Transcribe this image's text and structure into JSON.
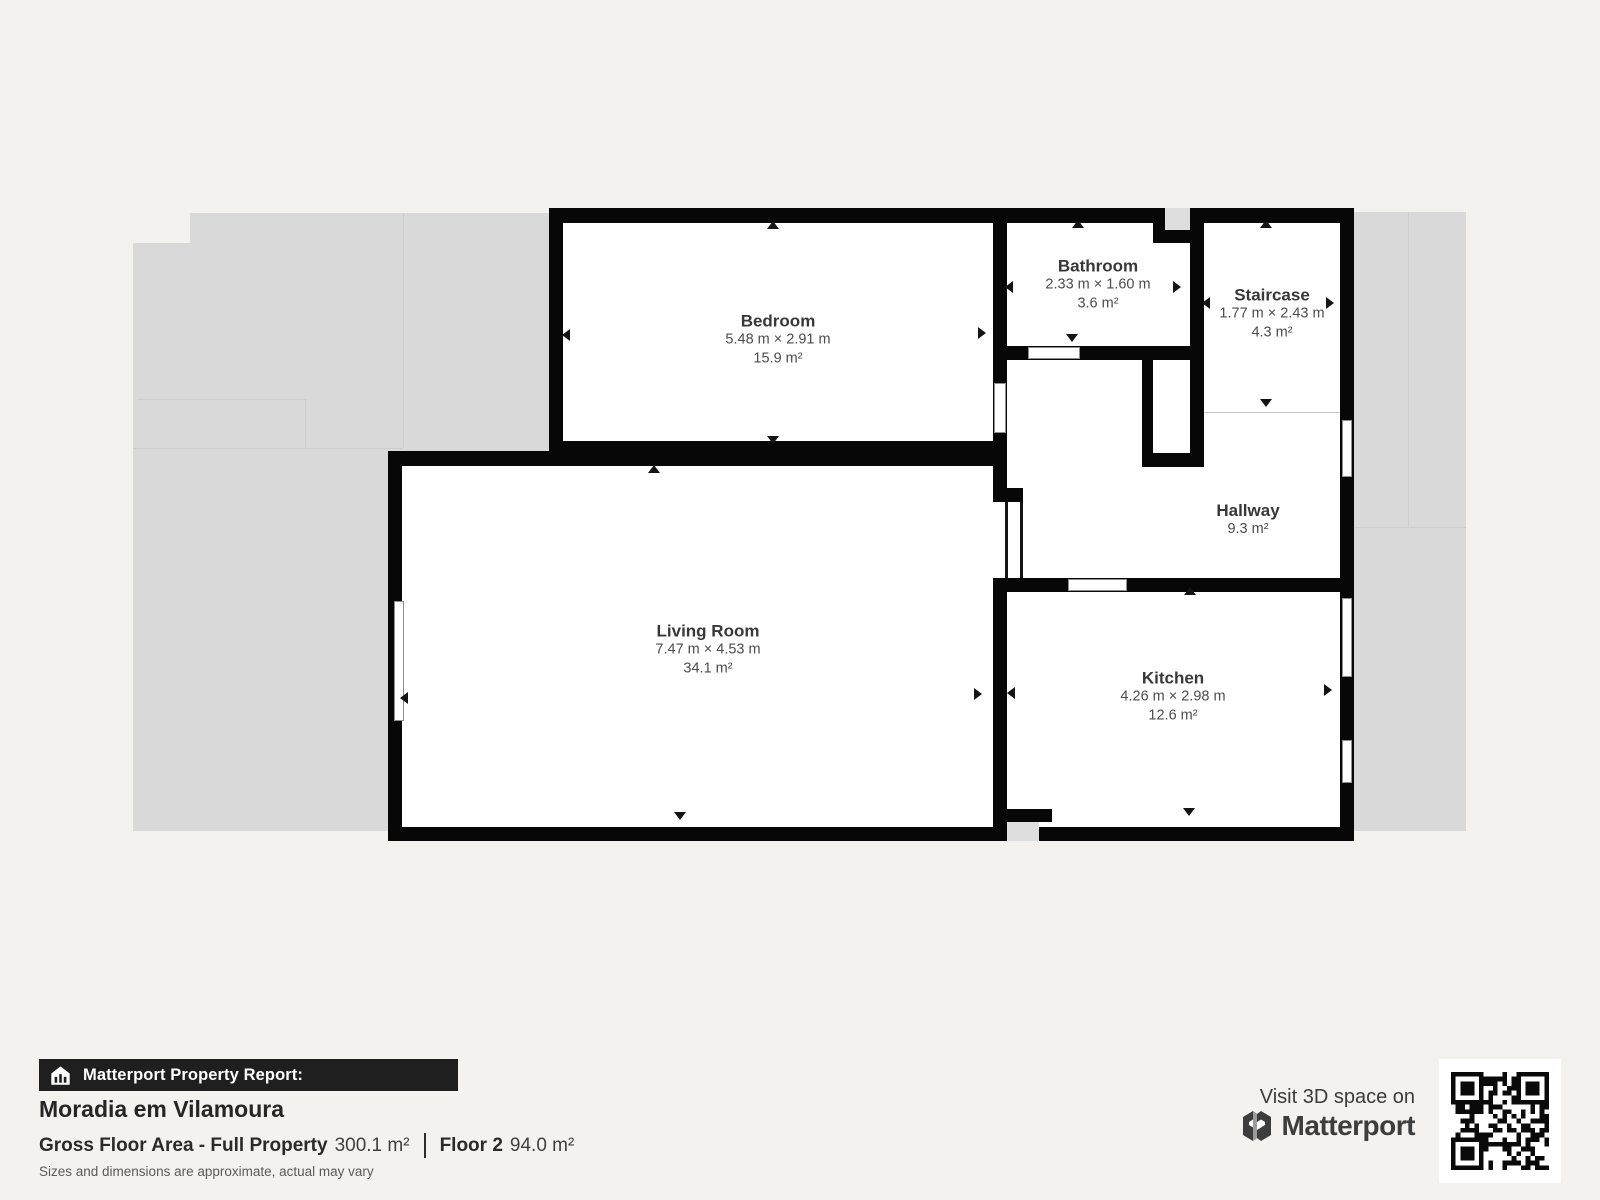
{
  "page": {
    "background": "#f3f2ef"
  },
  "floorplan": {
    "wall_color": "#070707",
    "silhouette_color": "#d9d9d9",
    "room_fill": "#ffffff",
    "rooms": [
      {
        "name": "Bedroom",
        "dimensions": "5.48 m × 2.91 m",
        "area": "15.9 m²"
      },
      {
        "name": "Bathroom",
        "dimensions": "2.33 m × 1.60 m",
        "area": "3.6 m²"
      },
      {
        "name": "Staircase",
        "dimensions": "1.77 m × 2.43 m",
        "area": "4.3 m²"
      },
      {
        "name": "Hallway",
        "area": "9.3 m²"
      },
      {
        "name": "Living Room",
        "dimensions": "7.47 m × 4.53 m",
        "area": "34.1 m²"
      },
      {
        "name": "Kitchen",
        "dimensions": "4.26 m × 2.98 m",
        "area": "12.6 m²"
      }
    ]
  },
  "report": {
    "bar_label": "Matterport Property Report:",
    "title": "Moradia em Vilamoura",
    "gross_floor_label": "Gross Floor Area - Full Property",
    "gross_floor_value": "300.1 m²",
    "floor_label": "Floor 2",
    "floor_value": "94.0 m²",
    "disclaimer": "Sizes and dimensions are approximate, actual may vary"
  },
  "cta": {
    "visit_label": "Visit 3D space on",
    "brand": "Matterport"
  }
}
